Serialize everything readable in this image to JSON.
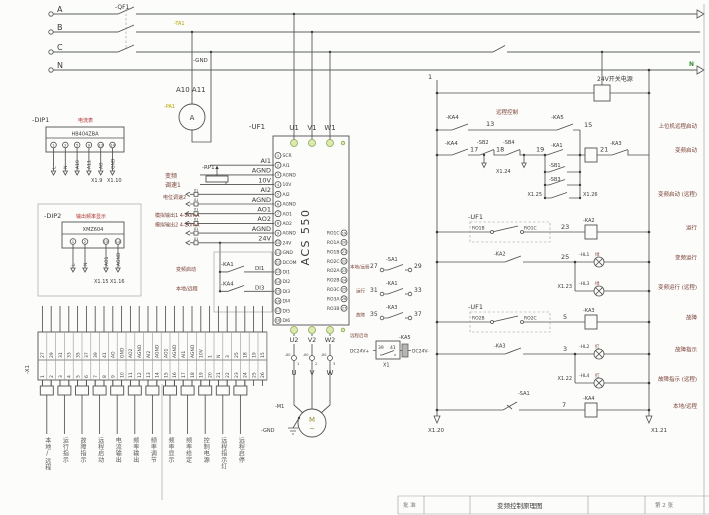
{
  "power": {
    "a": "A",
    "b": "B",
    "c": "C",
    "n": "N",
    "qf1": "-QF1",
    "ta1": "-TA1",
    "gnd": "-GND",
    "a10a11": "A10 A11",
    "pa1": "-PA1",
    "meter": "A"
  },
  "dip1": {
    "ref": "-DIP1",
    "title": "电流表",
    "model": "HB404ZBA",
    "pins": [
      {
        "n": "1",
        "w": "L"
      },
      {
        "n": "2",
        "w": "N"
      },
      {
        "n": "5",
        "w": "A10"
      },
      {
        "n": "9",
        "w": "A11"
      },
      {
        "n": "13",
        "w": "AO"
      },
      {
        "n": "14",
        "w": "GND"
      }
    ],
    "x9": "X1.9",
    "x10": "X1.10"
  },
  "dip2": {
    "ref": "-DIP2",
    "title": "输出频率显示",
    "model": "XMZ604",
    "t1": "1",
    "t2": "2",
    "t3": "15",
    "t4": "14",
    "w1": "L",
    "w2": "N",
    "w3": "AO1",
    "w4": "AGND",
    "x15": "X1.15",
    "x16": "X1.16"
  },
  "analog": {
    "rp1": "-RP1",
    "zh_vf": "变频",
    "zh_speed": "调速1",
    "zh_pot": "电位调速2",
    "zh_ao1": "模拟输出1 4-20mA",
    "zh_ao2": "模拟输出2 4-20mA",
    "x1": "X1",
    "labels": [
      "AI1",
      "AGND",
      "10V",
      "AI2",
      "AGND",
      "AO1",
      "AO2",
      "AGND",
      "24V"
    ]
  },
  "digital": {
    "ka1": "-KA1",
    "di1": "DI1",
    "ka4": "-KA4",
    "di3": "DI3",
    "zh1": "变频启动",
    "zh2": "本地/远程"
  },
  "drive": {
    "ref": "-UF1",
    "u1": "U1",
    "v1": "V1",
    "w1": "W1",
    "model": "ACS 550",
    "u2": "U2",
    "v2": "V2",
    "w2": "W2",
    "pins_left": [
      {
        "n": "1",
        "t": "SCR"
      },
      {
        "n": "2",
        "t": "AI1"
      },
      {
        "n": "3",
        "t": "AGND"
      },
      {
        "n": "4",
        "t": "10V"
      },
      {
        "n": "5",
        "t": "AI2"
      },
      {
        "n": "6",
        "t": "AGND"
      },
      {
        "n": "7",
        "t": "AO1"
      },
      {
        "n": "8",
        "t": "AO2"
      },
      {
        "n": "9",
        "t": "AGND"
      },
      {
        "n": "10",
        "t": "24V"
      },
      {
        "n": "11",
        "t": "GND"
      },
      {
        "n": "12",
        "t": "DCOM"
      },
      {
        "n": "13",
        "t": "DI1"
      },
      {
        "n": "14",
        "t": "DI2"
      },
      {
        "n": "15",
        "t": "DI3"
      },
      {
        "n": "16",
        "t": "DI4"
      },
      {
        "n": "17",
        "t": "DI5"
      },
      {
        "n": "18",
        "t": "DI6"
      }
    ],
    "pins_right": [
      {
        "t": "RO1C",
        "n": "19"
      },
      {
        "t": "RO1A",
        "n": "20"
      },
      {
        "t": "RO1B",
        "n": "21"
      },
      {
        "t": "RO2C",
        "n": "22"
      },
      {
        "t": "RO2A",
        "n": "23"
      },
      {
        "t": "RO2B",
        "n": "24"
      },
      {
        "t": "RO3C",
        "n": "25"
      },
      {
        "t": "RO3A",
        "n": "26"
      },
      {
        "t": "RO3B",
        "n": "27"
      }
    ]
  },
  "motor": {
    "ref": "-M1",
    "x0": "-X0",
    "n1": "1",
    "n2": "2",
    "n3": "3",
    "u": "U",
    "v": "V",
    "w": "W",
    "m": "M",
    "ac": "~",
    "gnd": "-GND"
  },
  "feedback": {
    "r1_zh": "本地/远程",
    "r1_a": "27",
    "r1_dev": "-SA1",
    "r1_b": "29",
    "r2_zh": "运行",
    "r2_a": "31",
    "r2_dev": "-KA1",
    "r2_b": "33",
    "r3_zh": "故障",
    "r3_a": "35",
    "r3_dev": "-KA3",
    "r3_b": "37",
    "r4_zh": "远程启动",
    "r4_plus": "DC24V+",
    "r4_a": "39",
    "r4_b": "41",
    "r4_dev": "-KA5",
    "r4_minus": "DC24V-",
    "r4_x": "X1"
  },
  "ladder": {
    "w1": "1",
    "psu": "24V开关电源",
    "n": "N",
    "r1c1": "-KA4",
    "r1w": "13",
    "r1zh": "远程控制",
    "r1c2": "-KA5",
    "r1w2": "15",
    "r1lbl": "上位机远程启动",
    "r2c1": "-KA4",
    "r2w1": "17",
    "r2c2": "-SB2",
    "r2w2": "18",
    "r2c3": "-SB4",
    "r2w3": "19",
    "r2x": "X1.24",
    "r2c4": "-KA1",
    "r2w4": "21",
    "r2c5": "-KA3",
    "r2lbl": "变频启动",
    "sb1": "-SB1",
    "sb3": "-SB3",
    "x125": "X1.25",
    "x126": "X1.26",
    "r2lbl2": "变频启动 (远程)",
    "r3ref": "-UF1",
    "r3a": "RO1B",
    "r3b": "RO1C",
    "r3w": "23",
    "r3coil": "-KA2",
    "r3lbl": "运行",
    "r4c": "-KA2",
    "r4w": "25",
    "r4lamp": "-HL1",
    "r4col": "绿",
    "r4lbl": "变频运行",
    "r4x": "X1.23",
    "r4lamp2": "-HL3",
    "r4col2": "绿",
    "r4lbl2": "变频运行 (远程)",
    "r5ref": "-UF1",
    "r5a": "RO2B",
    "r5b": "RO2C",
    "r5w": "5",
    "r5coil": "-KA3",
    "r5lbl": "故障",
    "r6c": "-KA3",
    "r6w": "3",
    "r6lamp": "-HL2",
    "r6col": "红",
    "r6lbl": "故障指示",
    "r6x": "X1.22",
    "r6lamp2": "-HL4",
    "r6col2": "红",
    "r6lbl2": "故障指示 (远程)",
    "r7c": "-SA1",
    "r7w": "7",
    "r7coil": "-KA4",
    "r7lbl": "本地/远程",
    "x120": "X1.20",
    "x121": "X1.21"
  },
  "strip": {
    "ref": "-X1",
    "cells": [
      {
        "w": "27",
        "n": "1"
      },
      {
        "w": "29",
        "n": "2"
      },
      {
        "w": "31",
        "n": "3"
      },
      {
        "w": "33",
        "n": "4"
      },
      {
        "w": "35",
        "n": "5"
      },
      {
        "w": "37",
        "n": "6"
      },
      {
        "w": "39",
        "n": "7"
      },
      {
        "w": "41",
        "n": "8"
      },
      {
        "w": "AO",
        "n": "9"
      },
      {
        "w": "GND",
        "n": "10"
      },
      {
        "w": "AO2",
        "n": "11"
      },
      {
        "w": "AGND",
        "n": "12"
      },
      {
        "w": "AI2",
        "n": "13"
      },
      {
        "w": "AGND",
        "n": "14"
      },
      {
        "w": "AO1",
        "n": "15"
      },
      {
        "w": "AGND",
        "n": "16"
      },
      {
        "w": "AI1",
        "n": "17"
      },
      {
        "w": "AGND",
        "n": "18"
      },
      {
        "w": "10V",
        "n": "19"
      },
      {
        "w": "1",
        "n": "20"
      },
      {
        "w": "N",
        "n": "21"
      },
      {
        "w": "3",
        "n": "22"
      },
      {
        "w": "25",
        "n": "23"
      },
      {
        "w": "18",
        "n": "24"
      },
      {
        "w": "19",
        "n": "25"
      },
      {
        "w": "15",
        "n": "26"
      }
    ],
    "functions": [
      "本地/远程",
      "运行指示",
      "故障指示",
      "远程启动",
      "电流输出",
      "频率输出",
      "频率调节",
      "频率显示",
      "频率给定",
      "控制电源",
      "远程指示灯",
      "远程启停"
    ]
  },
  "titleblock": {
    "c1": "批 准",
    "c2": "变频控制原理图",
    "c3": "第 2 张"
  }
}
